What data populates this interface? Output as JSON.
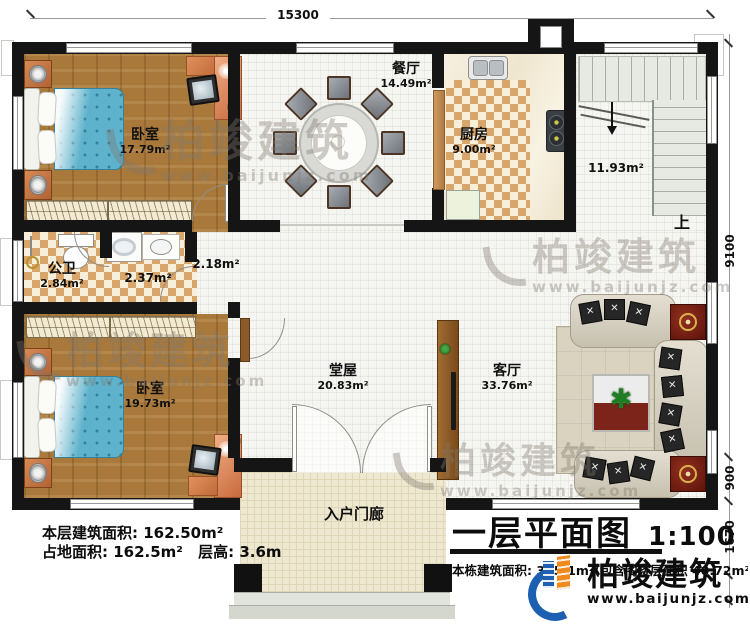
{
  "dimensions": {
    "top": "15300",
    "right_main": "9100",
    "right_step": "900",
    "right_porch": "1670"
  },
  "rooms": {
    "bedroom_top": {
      "name": "卧室",
      "area": "17.79m²"
    },
    "dining": {
      "name": "餐厅",
      "area": "14.49m²"
    },
    "kitchen": {
      "name": "厨房",
      "area": "9.00m²"
    },
    "stairs": {
      "area": "11.93m²",
      "direction": "上"
    },
    "bathroom": {
      "name": "公卫",
      "area": "2.84m²"
    },
    "laundry": {
      "area": "2.37m²"
    },
    "hallway": {
      "area": "2.18m²"
    },
    "bedroom_bottom": {
      "name": "卧室",
      "area": "19.73m²"
    },
    "hall": {
      "name": "堂屋",
      "area": "20.83m²"
    },
    "living": {
      "name": "客厅",
      "area": "33.76m²"
    },
    "porch": {
      "name": "入户门廊"
    }
  },
  "stats": {
    "floor_area": "本层建筑面积: 162.50m²",
    "land_area": "占地面积: 162.5m²",
    "storey_height": "层高: 3.6m"
  },
  "title_block": {
    "title": "一层平面图",
    "scale": "1:100",
    "total_area_note": "本栋建筑面积: 325.1m²(包含阁楼层面积 40.72m²)"
  },
  "branding": {
    "company": "柏竣建筑",
    "website": "www.baijunjz.com"
  },
  "colors": {
    "wall": "#151515",
    "wood_floor": "#a9793c",
    "checker_tan": "#d8a66b",
    "accent_blue": "#1d5fb0",
    "accent_orange": "#f08a1e",
    "bed_blue": "#5eb2cb"
  }
}
